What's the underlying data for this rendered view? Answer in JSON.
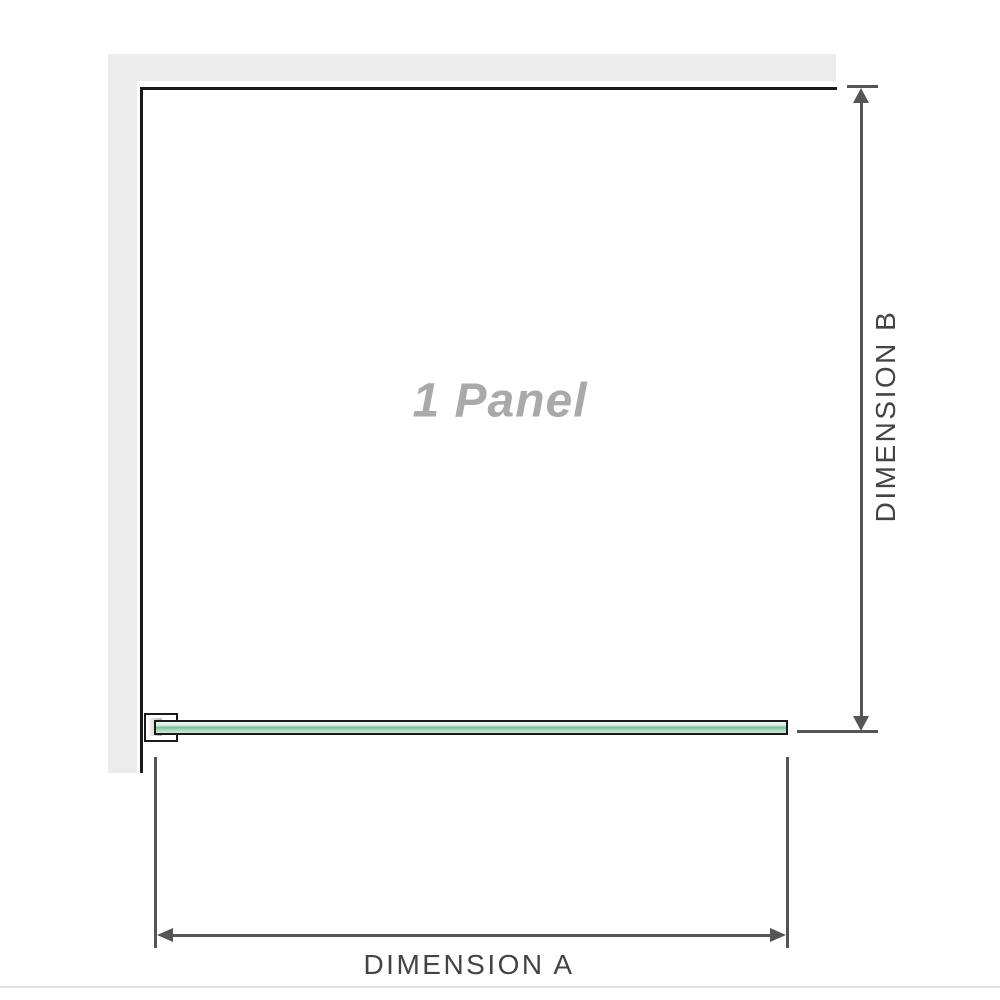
{
  "diagram": {
    "panel_label": "1 Panel",
    "dimension_a_label": "DIMENSION A",
    "dimension_b_label": "DIMENSION B"
  },
  "colors": {
    "wall": "#ececec",
    "outline": "#1a1a1a",
    "dimension_lines": "#555555",
    "dimension_text": "#444444",
    "panel_text": "#a9a9a9",
    "glass_light": "#d5eede",
    "glass_mid": "#9ed2b3",
    "glass_dark": "#7fb899",
    "divider": "#e0e0dd"
  }
}
